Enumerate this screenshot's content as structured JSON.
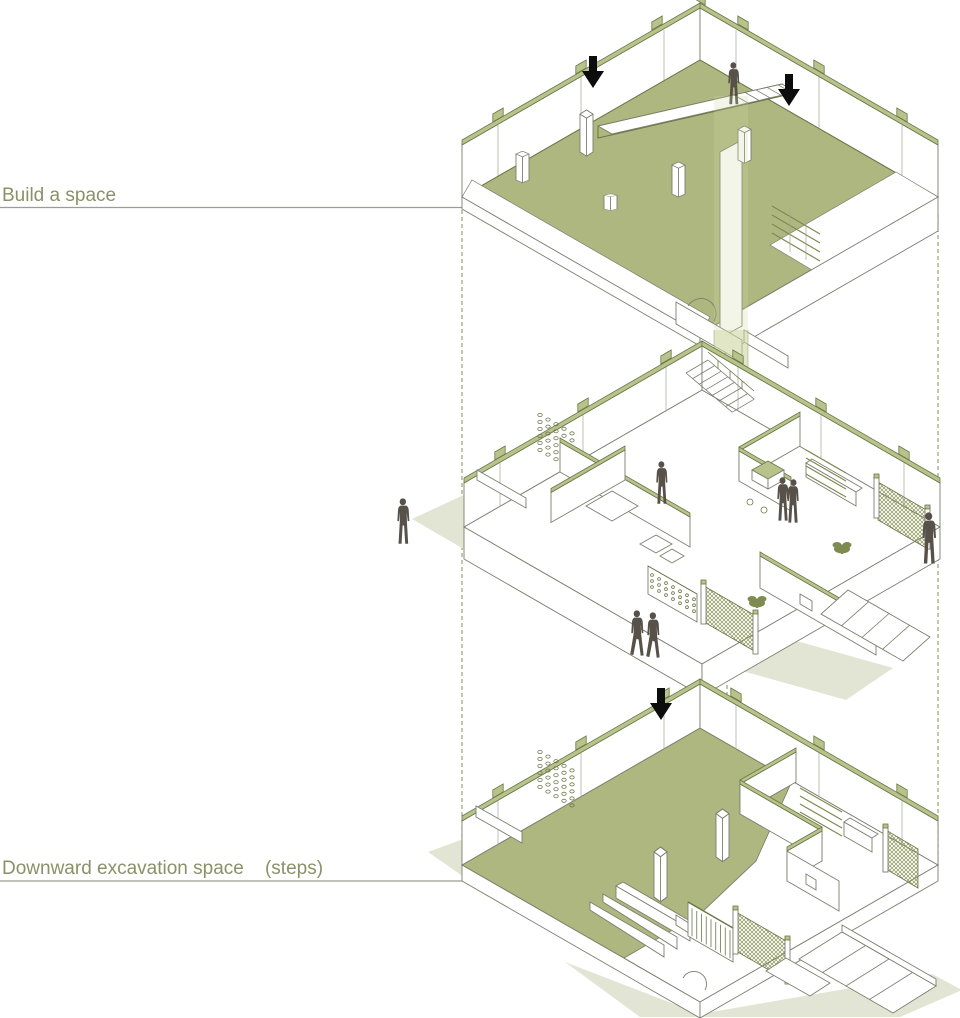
{
  "diagram": {
    "type": "exploded-axonometric",
    "callouts": [
      {
        "id": "build_space",
        "text": "Build a space",
        "points_to": "upper-level-floor"
      },
      {
        "id": "excavation",
        "text": "Downward excavation space    (steps)",
        "points_to": "lower-level-floor"
      }
    ],
    "levels": [
      {
        "id": "upper-level"
      },
      {
        "id": "middle-level"
      },
      {
        "id": "lower-level"
      }
    ],
    "icons": {
      "down_arrow_count": 3,
      "figure_count": 8,
      "plant_count": 2
    }
  },
  "colors": {
    "background": "#ffffff",
    "floor_green": "#aeb77f",
    "wall_cap_green": "#b8c28b",
    "outline_olive": "#6c7747",
    "outline_gray": "#7b7f6e",
    "mesh_olive": "#8a9456",
    "light_shaft_green": "#cbd6a0",
    "shadow_green": "#e2e5d4",
    "guide_dash_olive": "#8f9a62",
    "figure_brown": "#57514a",
    "arrow_black": "#0d0d0d",
    "label_olive": "#8a9167",
    "leader_gray": "#9a9e8e"
  }
}
